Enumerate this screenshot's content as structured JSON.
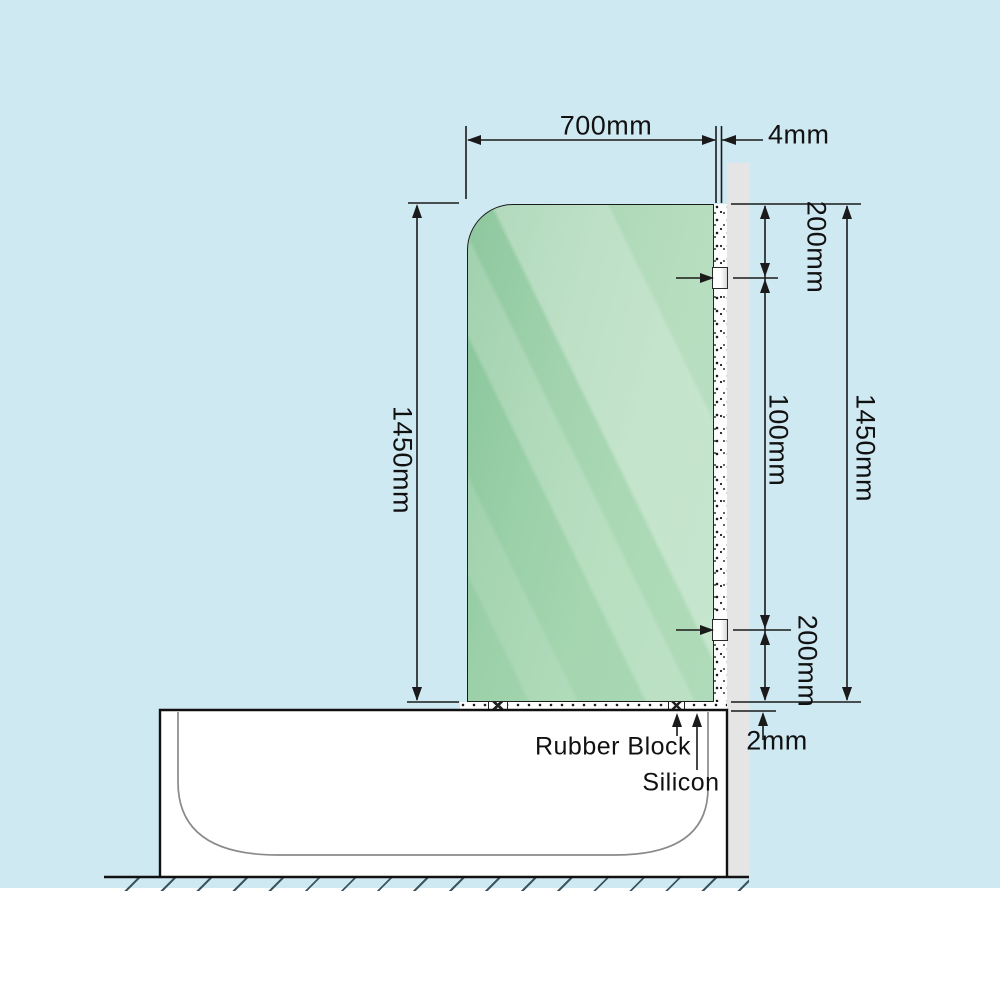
{
  "scene": {
    "background_color": "#cfe9f2",
    "glass_color": "#9bd0a8",
    "wall_color": "#e5e5e5",
    "line_color": "#1a1a1a"
  },
  "dimensions": {
    "glass_width": "700mm",
    "glass_to_wall_gap": "4mm",
    "top_bracket_offset": "200mm",
    "between_brackets": "100mm",
    "bottom_bracket_offset": "200mm",
    "glass_height": "1450mm",
    "wall_side_height": "1450mm",
    "bottom_silicon_gap": "2mm"
  },
  "annotations": {
    "rubber_block": "Rubber Block",
    "silicon": "Silicon"
  }
}
